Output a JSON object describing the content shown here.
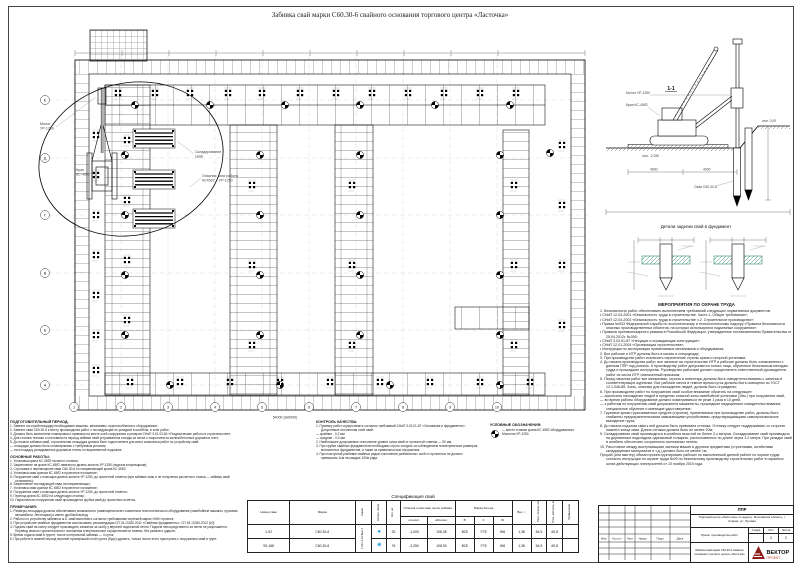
{
  "sheet_title": "Забивка свай марки С60.30-6 свайного основания торгового центра «Ласточка»",
  "plan": {
    "labels": {
      "hammer1": "Молот",
      "hammer2": "УР-1250",
      "crane1": "Кран",
      "crane2": "КС-45б2",
      "storage1": "Складирование",
      "storage2": "свай",
      "zone1": "Опасная зона работы",
      "zone2": "КС45б2 + УР-1250",
      "dim_bottom": "54000 (9х6000)"
    },
    "axes_bottom": [
      "1",
      "2",
      "3",
      "4",
      "5",
      "6",
      "7",
      "8",
      "9",
      "10"
    ],
    "axes_left": [
      "Е",
      "Д",
      "Г",
      "В",
      "Б",
      "А"
    ]
  },
  "section": {
    "title": "1-1",
    "labels": {
      "hammer": "Молот УР-1250",
      "crane": "Кран КС-45б2",
      "pile": "Сваи С60.30-6",
      "elev_zero": "отм. 0,00",
      "elev_platform": "отм. -2,250",
      "dim1": "4000",
      "dim2": "4000"
    }
  },
  "details": {
    "title": "Детали заделки свай в фундамент"
  },
  "prep": {
    "title": "ПОДГОТОВИТЕЛЬНЫЙ ПЕРИОД:",
    "items": [
      "1. Завезти на стройплощадку необходимые машины, механизмы, приспособления и оборудование;",
      "2. Завезти сваи С60.30-6 к месту производства работ с последующей их укладкой в штабеля, в зоне работ;",
      "3. Должна быть выполнена планировка и привязка на месте осей сооружения и реперов СНиП 3.01.03-84 «Геодезические работы в строительстве»;",
      "4. Для стоянки техники и котлована на период забивки свай устраиваются съезды из песка с покрытием из железобетонных дорожных плит;",
      "5. До начала забивки свай, строительная площадка должна быть подготовлена для всего комплекса работ по устройству свай:",
      "— площадки должны быть спланированы с требуемым уклоном;",
      "— на площадку укладываются дорожные плиты по выровненной подсыпке;"
    ]
  },
  "works": {
    "title": "ОСНОВНЫЕ РАБОТЫ:",
    "items": [
      "1. Установка крана КС-45б2 на место стоянки;",
      "2. Закрепление на кране КС-45б2 навесного дизель-молота УР-1250 (подъем копровщиков);",
      "3. Строповка и перемещение сваи С60.30-6 по направляющей крана КС 45б2;",
      "4. Установка сваи краном КС 45б2 в проектное положение;",
      "5. Погружение свай с помощью дизель-молота УР-1250, до проектной отметки (при забивке сваи и не получении расчетного отказа — забивку свай остановить);",
      "6. Закрепление последующей сваи на направляющих;",
      "7. Установка сваи краном КС 45б2 в проектное положение;",
      "8. Погружение свай с помощью дизель-молота УР-1250, до проектной отметки;",
      "9. Переход крана КС 45б2 на следующую стоянку;",
      "10. Параллельно погружению свай производится срубка свай до проектных отметок."
    ]
  },
  "notes": {
    "title": "ПРИМЕЧАНИЯ:",
    "items": [
      "1. Размеры площадки должны обеспечивать возможность размещения всего комплекса технологического оборудования (сваебойные машины, грузовые автомобили, бетонщики) и иметь удобный выезд;",
      "2. Работы по устройству забивных ж.б. свай выполнять согласно требованиям чертежей марки «КЖ» проекта;",
      "3. При устройстве свайных фундаментов использовать рекомендации СП 24.13330.2011 «Свайные фундаменты», СП 45.13330.2012 [10];",
      "4. Подъем свай на копер следует производить захватом за скобу у верхней подъемной петли. Подъем непосредственно за петли не разрешается. Перевод сваи из горизонтального положения в вертикальное осуществляется плавно, без рывков и ударов;",
      "5. Время отдыха свай в грунте, после контрольной забивки — 4 суток;",
      "6. При работе в зимний период верхний промерзший слой грунта (брус) удалить, только после этого приступать к погружению свай в грунт."
    ]
  },
  "quality": {
    "title": "КОНТРОЛЬ КАЧЕСТВА:",
    "items": [
      "1. Приемку работ осуществлять согласно требований СНиП 3.02.01-87 «Основания и фундаменты». Допустимые отклонения осей свай:",
      "— крайние - 0,2 мм",
      "— средние - 0,4 мм",
      "2. Наибольшее допускаемое отклонение уровня голов свай от проектной отметки — 50 мм.",
      "3. При срубке свайных фундаментов необходимо строго следить за соблюдением геометрических размеров монолитных фундаментов, а также за правильностью погружения.",
      "4. При поштучной разбивке свайных рядов отклонение разбивочных осей от проектных не должно превышать 1см на каждые 100м ряда."
    ]
  },
  "legend": {
    "title": "УСЛОВНЫЕ ОБОЗНАЧЕНИЯ:",
    "crane_stand": "— место стоянки крана КС 45б2 оборудованного Молотом УР-1250"
  },
  "safety": {
    "title": "МЕРОПРИЯТИЯ ПО ОХРАНЕ ТРУДА",
    "items": [
      "1. Безопасность работ обеспечивать выполнением требований следующих нормативных документов:",
      "• СНиП 12-03-2001 «Безопасность труда в строительстве. Часть 1. Общие требования»;",
      "• СНиП 12-04-2002 «Безопасность труда в строительстве ч.2. Строительное производство»;",
      "• Приказ №533 Федеральной службы по экологическому и технологическому надзору «Правила безопасности опасных производственных объектов, на которых используются подъемные сооружения»;",
      "• Правила противопожарного режима в Российской Федерации, утвержденные постановлением Правительства от 25.04.2012г. №390;",
      "• СНиП 3.03.01-87 «Несущие и ограждающие конструкции»;",
      "• СНиП 12-01-2004 «Организация строительства»;",
      "• Инструкции по эксплуатации применяемых механизмов и оборудования;",
      "2. Все рабочие и ИТР должны быть в касках и спецодежде;",
      "3. При производстве работ исключить пересечение стрелы крана и опорной установки;",
      "4. До начала производства работ, все занятые на строительстве ИТР и рабочие должны быть ознакомлены с данным ППР под роспись. К производству работ допускаются только лица, обученные безопасным методам труда и прошедшие инструктаж. Руководство работами должен осуществлять ответственный руководитель работ из числа ИТР, назначенный приказом;",
      "5. Перед началом работ все механизмы, стропы и инвентарь должны быть освидетельствованы с записью в соответствующих журналах. Все рабочие места в темное время суток должны быть освещены по ГОСТ 12.1.046-85. Зоны, опасные для нахождения людей, должны быть ограждены;",
      "6. При производстве работ по погружению свай особое внимание обратить на следующее:",
      "— исключить нахождение людей в пределах опасной зоны сваебойной установки (15м.) при погружении свай,",
      "— во время работы оборудование должно осматриваться не реже 1 раза в 10 дней,",
      "— к работам по погружению свай допускаются машинисты, прошедшие медицинское освидетельствование, специальное обучение и имеющие удостоверение;",
      "7. Грузовые крюки грузозахватных средств (стропов), применяемых при производстве работ, должны быть снабжены предохранительными замыкающими устройствами, предотвращающими самопроизвольное выпадение груза;",
      "8. До начала подъема сваи к ней должна быть привязана оттяжка. Оттяжку следует поддерживать со стороны нижнего конца сваи. Длина оттяжки должна быть не менее 20м;",
      "9. Складирование свай производится в штабеля высотой не более 2-х метров. Складирование свай производить на деревянных подкладках одинаковой толщины, расположенных по длине через 1-2 метра. При укладке свай в штабель обеспечить сохранность монтажных петель;",
      "10. Расстояние между выступающими частями машин и другими предметами (строениями, штабелями складируемых материалов и т.д.) должно быть не менее 1м.",
      "Прораб (или мастер) обязан проинструктировать рабочих по выполняемой данной работе по охране труда согласно инструкции по охране труда №09 по безопасному производству строительных работ в охранных зонах действующих электросетей от 10 ноября 2015 года."
    ]
  },
  "spec": {
    "title": "Спецификация свай",
    "h": {
      "num": "Номер сваи",
      "mark": "Марка",
      "series": "Серия",
      "sym": "Условн. обозн.",
      "count": "Кол, шт.",
      "head": "Отметка голов сваи после забивки",
      "rel": "относит.",
      "abs": "абсолют.",
      "grade": "Марка бетона",
      "b": "В",
      "f": "F",
      "w": "W",
      "weight": "Вес, т",
      "vol": "Расх. бетона, м3",
      "metal": "Расх. металла, кг",
      "note": "Примечание"
    },
    "series_val": "1.011.1-10 Вып.1",
    "rows": [
      {
        "num": "1-92",
        "mark": "С60.30-6",
        "sym": "●",
        "count": "92",
        "rel": "-1,000",
        "abs": "108,35",
        "b": "В25",
        "f": "F75",
        "w": "W6",
        "weight": "1,38",
        "vol": "54,9",
        "metal": "69,8",
        "note": ""
      },
      {
        "num": "93-168",
        "mark": "С60.30-6",
        "sym": "⊕",
        "count": "76",
        "rel": "-2,250",
        "abs": "108,90",
        "b": "В25",
        "f": "F75",
        "w": "W6",
        "weight": "1,38",
        "vol": "54,9",
        "metal": "69,8",
        "note": ""
      }
    ]
  },
  "title_block": {
    "code": "ППР",
    "object": "Торговый центр «Ласточка» по адресу: Московская область, г. Старая, ул. Луговая",
    "doc": "Проект производства работ",
    "stage_label": "Стадия",
    "sheet_label": "Лист",
    "sheets_label": "Листов",
    "stage": "",
    "sheet": "2",
    "sheets": "2",
    "name": "Забивка свай марки С60.30-6 свайного основания торгового центра «Ласточка»",
    "brand": "ВЕКТОР",
    "brand_sub": "ПРОЕКТ",
    "rev": [
      "Изм.",
      "Кол.уч",
      "Лист",
      "№док.",
      "Подп.",
      "Дата"
    ]
  }
}
